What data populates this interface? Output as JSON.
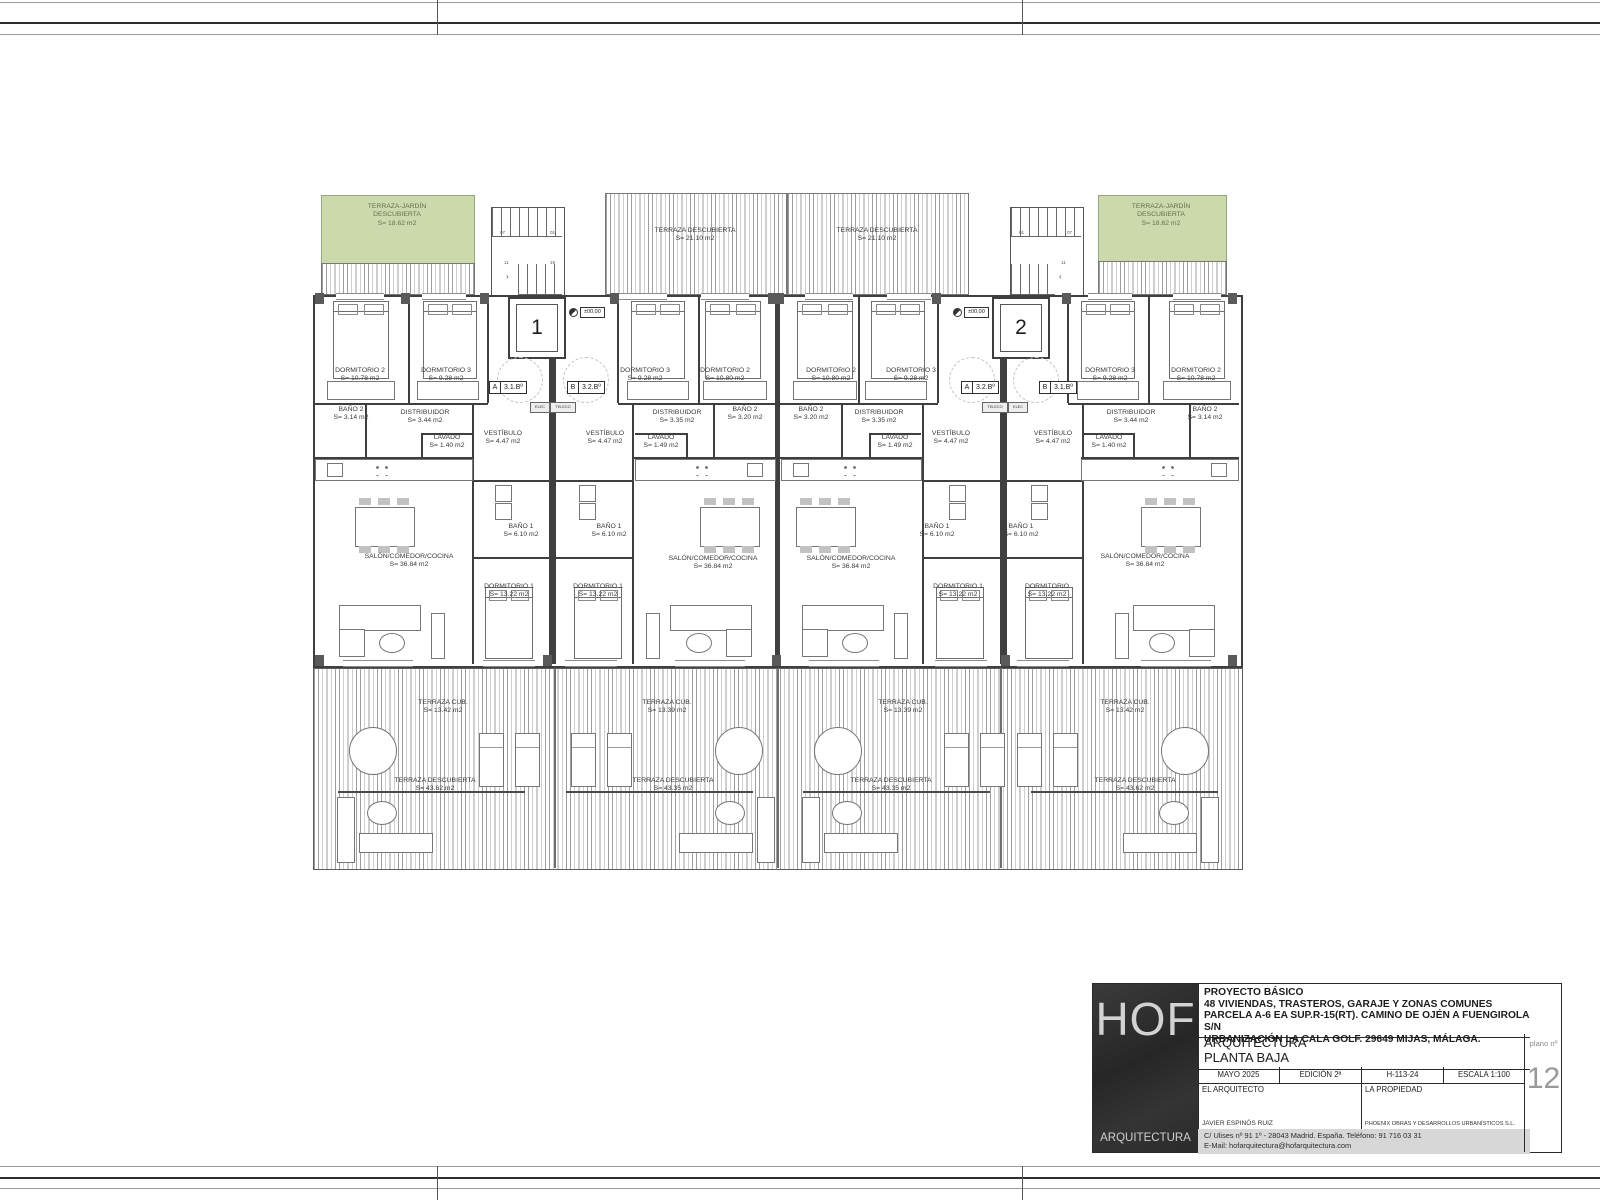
{
  "plan": {
    "labels": [
      {
        "n": "TERRAZA-JARDÍN DESCUBIERTA",
        "a": "S= 18.62 m2"
      },
      {
        "n": "TERRAZA DESCUBIERTA",
        "a": "S= 21.10 m2"
      },
      {
        "n": "TERRAZA DESCUBIERTA",
        "a": "S= 21.10 m2"
      },
      {
        "n": "TERRAZA-JARDÍN DESCUBIERTA",
        "a": "S= 18.62 m2"
      },
      {
        "n": "DORMITORIO 2",
        "a": "S= 10.78 m2"
      },
      {
        "n": "DORMITORIO 3",
        "a": "S= 9.28 m2"
      },
      {
        "n": "DORMITORIO 3",
        "a": "S= 9.28 m2"
      },
      {
        "n": "DORMITORIO 2",
        "a": "S= 10.80 m2"
      },
      {
        "n": "DORMITORIO 2",
        "a": "S= 10.80 m2"
      },
      {
        "n": "DORMITORIO 3",
        "a": "S= 9.28 m2"
      },
      {
        "n": "DORMITORIO 3",
        "a": "S= 9.28 m2"
      },
      {
        "n": "DORMITORIO 2",
        "a": "S= 10.78 m2"
      },
      {
        "n": "BAÑO 2",
        "a": "S= 3.14 m2"
      },
      {
        "n": "DISTRIBUIDOR",
        "a": "S= 3.44 m2"
      },
      {
        "n": "LAVADO",
        "a": "S= 1.40 m2"
      },
      {
        "n": "DISTRIBUIDOR",
        "a": "S= 3.35 m2"
      },
      {
        "n": "BAÑO 2",
        "a": "S= 3.20 m2"
      },
      {
        "n": "LAVADO",
        "a": "S= 1.49 m2"
      },
      {
        "n": "BAÑO 2",
        "a": "S= 3.20 m2"
      },
      {
        "n": "DISTRIBUIDOR",
        "a": "S= 3.35 m2"
      },
      {
        "n": "LAVADO",
        "a": "S= 1.49 m2"
      },
      {
        "n": "DISTRIBUIDOR",
        "a": "S= 3.44 m2"
      },
      {
        "n": "BAÑO 2",
        "a": "S= 3.14 m2"
      },
      {
        "n": "LAVADO",
        "a": "S= 1.40 m2"
      },
      {
        "n": "VESTÍBULO",
        "a": "S= 4.47 m2"
      },
      {
        "n": "VESTÍBULO",
        "a": "S= 4.47 m2"
      },
      {
        "n": "VESTÍBULO",
        "a": "S= 4.47 m2"
      },
      {
        "n": "VESTÍBULO",
        "a": "S= 4.47 m2"
      },
      {
        "n": "BAÑO 1",
        "a": "S= 6.10 m2"
      },
      {
        "n": "BAÑO 1",
        "a": "S= 6.10 m2"
      },
      {
        "n": "BAÑO 1",
        "a": "S= 6.10 m2"
      },
      {
        "n": "BAÑO 1",
        "a": "S= 6.10 m2"
      },
      {
        "n": "DORMITORIO 1",
        "a": "S= 13.22 m2"
      },
      {
        "n": "DORMITORIO 1",
        "a": "S= 13.22 m2"
      },
      {
        "n": "DORMITORIO 1",
        "a": "S= 13.22 m2"
      },
      {
        "n": "DORMITORIO",
        "a": "S= 13.22 m2"
      },
      {
        "n": "SALÓN/COMEDOR/COCINA",
        "a": "S= 36.84 m2"
      },
      {
        "n": "SALÓN/COMEDOR/COCINA",
        "a": "S= 36.84 m2"
      },
      {
        "n": "SALÓN/COMEDOR/COCINA",
        "a": "S= 36.84 m2"
      },
      {
        "n": "SALÓN/COMEDOR/COCINA",
        "a": "S= 36.84 m2"
      },
      {
        "n": "TERRAZA CUB.",
        "a": "S= 13.42 m2"
      },
      {
        "n": "TERRAZA CUB.",
        "a": "S= 13.39 m2"
      },
      {
        "n": "TERRAZA CUB.",
        "a": "S= 13.39 m2"
      },
      {
        "n": "TERRAZA CUB.",
        "a": "S= 13.42 m2"
      },
      {
        "n": "TERRAZA DESCUBIERTA",
        "a": "S= 43.62 m2"
      },
      {
        "n": "TERRAZA DESCUBIERTA",
        "a": "S= 43.35 m2"
      },
      {
        "n": "TERRAZA DESCUBIERTA",
        "a": "S= 43.35 m2"
      },
      {
        "n": "TERRAZA DESCUBIERTA",
        "a": "S= 43.62 m2"
      }
    ],
    "unit_tags": [
      {
        "letter": "A",
        "code": "3.1.Bº"
      },
      {
        "letter": "B",
        "code": "3.2.Bº"
      },
      {
        "letter": "A",
        "code": "3.2.Bº"
      },
      {
        "letter": "B",
        "code": "3.1.Bº"
      }
    ],
    "elevators": [
      "1",
      "2"
    ],
    "level_marker": "±00.00",
    "stair_left": [
      "07",
      "01",
      "11",
      "19"
    ],
    "stair_right": [
      "01",
      "07",
      "11"
    ],
    "utility_boxes": [
      "ELEC",
      "TELECO"
    ]
  },
  "title_block": {
    "logo": "HOF",
    "logo_sub": "ARQUITECTURA",
    "project_line1": "PROYECTO BÁSICO",
    "project_line2": "48 VIVIENDAS, TRASTEROS,  GARAJE Y ZONAS COMUNES",
    "project_line3": "PARCELA A-6 EA SUP.R-15(RT). CAMINO DE OJÉN A FUENGIROLA S/N",
    "project_line4": "URBANIZACIÓN LA CALA GOLF. 29649 MIJAS, MÁLAGA.",
    "discipline": "ARQUITECTURA",
    "sheet_name": "PLANTA BAJA",
    "date": "MAYO 2025",
    "edition": "EDICIÓN 2ª",
    "code": "H-113-24",
    "scale": "ESCALA 1:100",
    "architect_label": "EL ARQUITECTO",
    "architect_name": "JAVIER ESPINÓS RUIZ",
    "owner_label": "LA PROPIEDAD",
    "owner_name": "PHOENIX OBRAS Y DESARROLLOS URBANÍSTICOS S.L.",
    "address": "C/ Ulises nº 91  1º - 28043  Madrid. España. Teléfono:  91 716 03 31",
    "email": "E-Mail: hofarquitectura@hofarquitectura.com",
    "plano_label": "plano nº",
    "plano_number": "12"
  },
  "colors": {
    "terrace_green": "#ccd9ad",
    "wall": "#3f3f3f",
    "hatch": "#9f9f9f"
  }
}
